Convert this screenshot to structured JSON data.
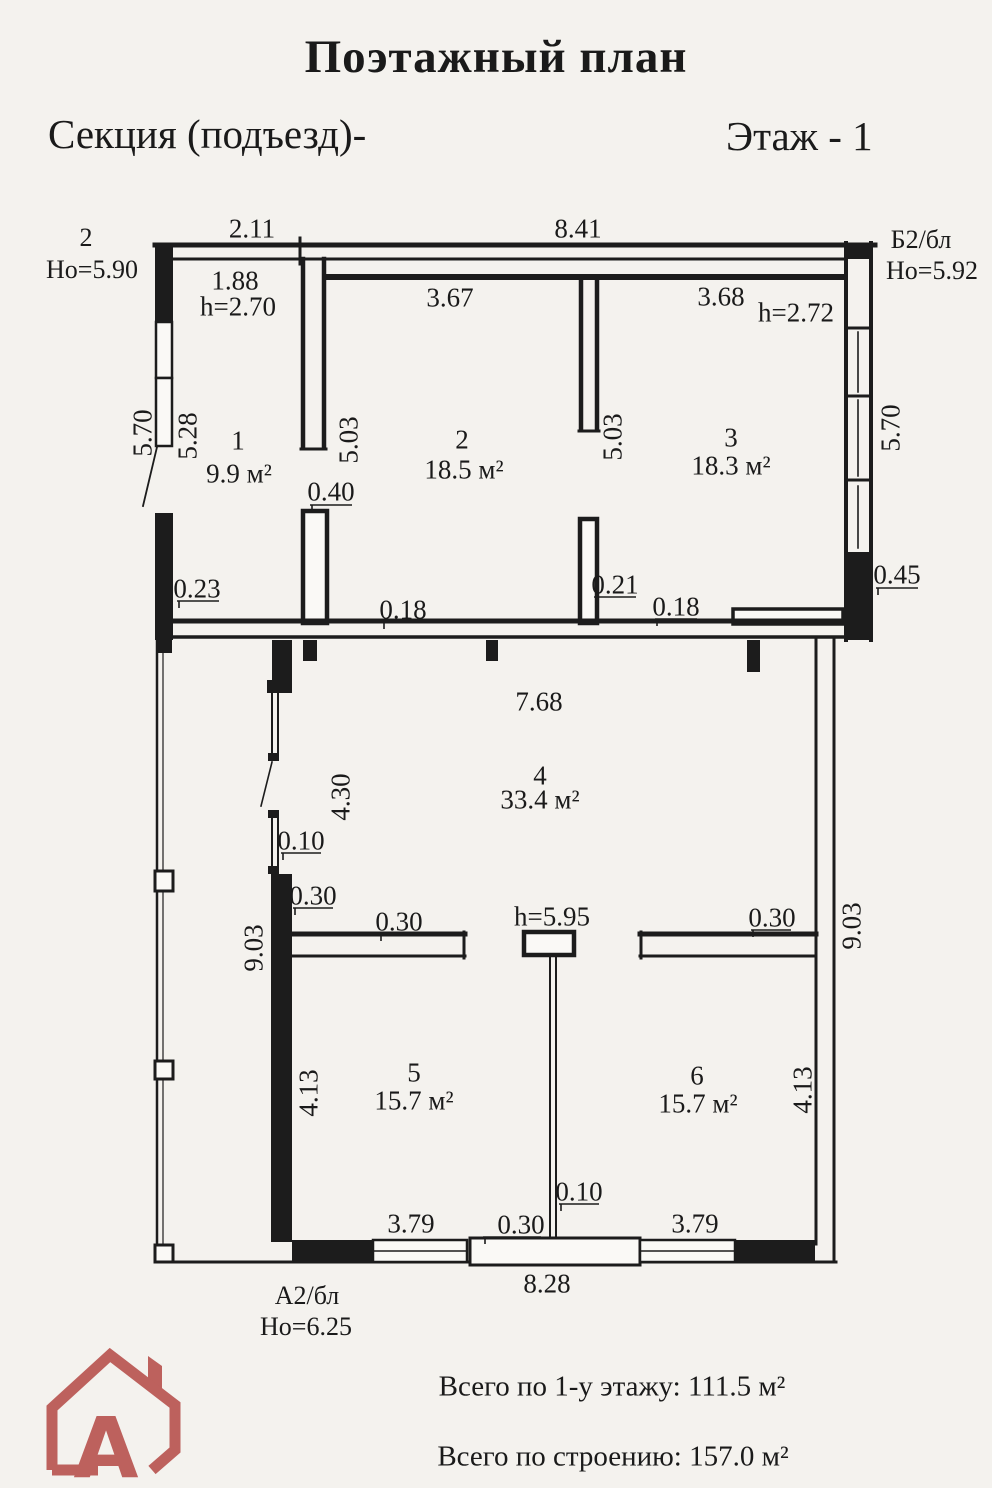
{
  "header": {
    "title": "Поэтажный план",
    "section": "Секция (подъезд)-",
    "floor": "Этаж - 1"
  },
  "corners": {
    "top_left_number": "2",
    "top_left_height": "Но=5.90",
    "top_right_block": "Б2/бл",
    "top_right_height": "Но=5.92",
    "bottom_block": "А2/бл",
    "bottom_height": "Но=6.25"
  },
  "rooms": [
    {
      "number": "1",
      "area": "9.9 м²"
    },
    {
      "number": "2",
      "area": "18.5 м²"
    },
    {
      "number": "3",
      "area": "18.3 м²"
    },
    {
      "number": "4",
      "area": "33.4 м²"
    },
    {
      "number": "5",
      "area": "15.7 м²"
    },
    {
      "number": "6",
      "area": "15.7 м²"
    }
  ],
  "room_heights": {
    "room1": "h=2.70",
    "room3": "h=2.72",
    "hall": "h=5.95"
  },
  "dimensions": {
    "top_left": "2.11",
    "top_right": "8.41",
    "room1_width": "1.88",
    "room2_width": "3.67",
    "room3_width": "3.68",
    "left_outer": "5.70",
    "left_inner": "5.28",
    "partition12": "5.03",
    "partition23": "5.03",
    "right_outer": "5.70",
    "wall_040": "0.40",
    "wall_023": "0.23",
    "wall_018_left": "0.18",
    "wall_021": "0.21",
    "wall_018_right": "0.18",
    "wall_045": "0.45",
    "hall_width": "7.68",
    "hall_height": "4.30",
    "glazing_010": "0.10",
    "wall_030_left": "0.30",
    "stub_030_room5": "0.30",
    "stub_030_room6": "0.30",
    "left_side": "9.03",
    "right_side": "9.03",
    "room5_height": "4.13",
    "room6_height": "4.13",
    "partition56_010": "0.10",
    "door_030": "0.30",
    "room5_width": "3.79",
    "room6_width": "3.79",
    "bottom_width": "8.28"
  },
  "footer": {
    "floor_total": "Всего по 1-у этажу: 111.5 м²",
    "building_total": "Всего по строению: 157.0 м²"
  },
  "logo": {
    "letter": "А",
    "color": "#bd615d"
  }
}
